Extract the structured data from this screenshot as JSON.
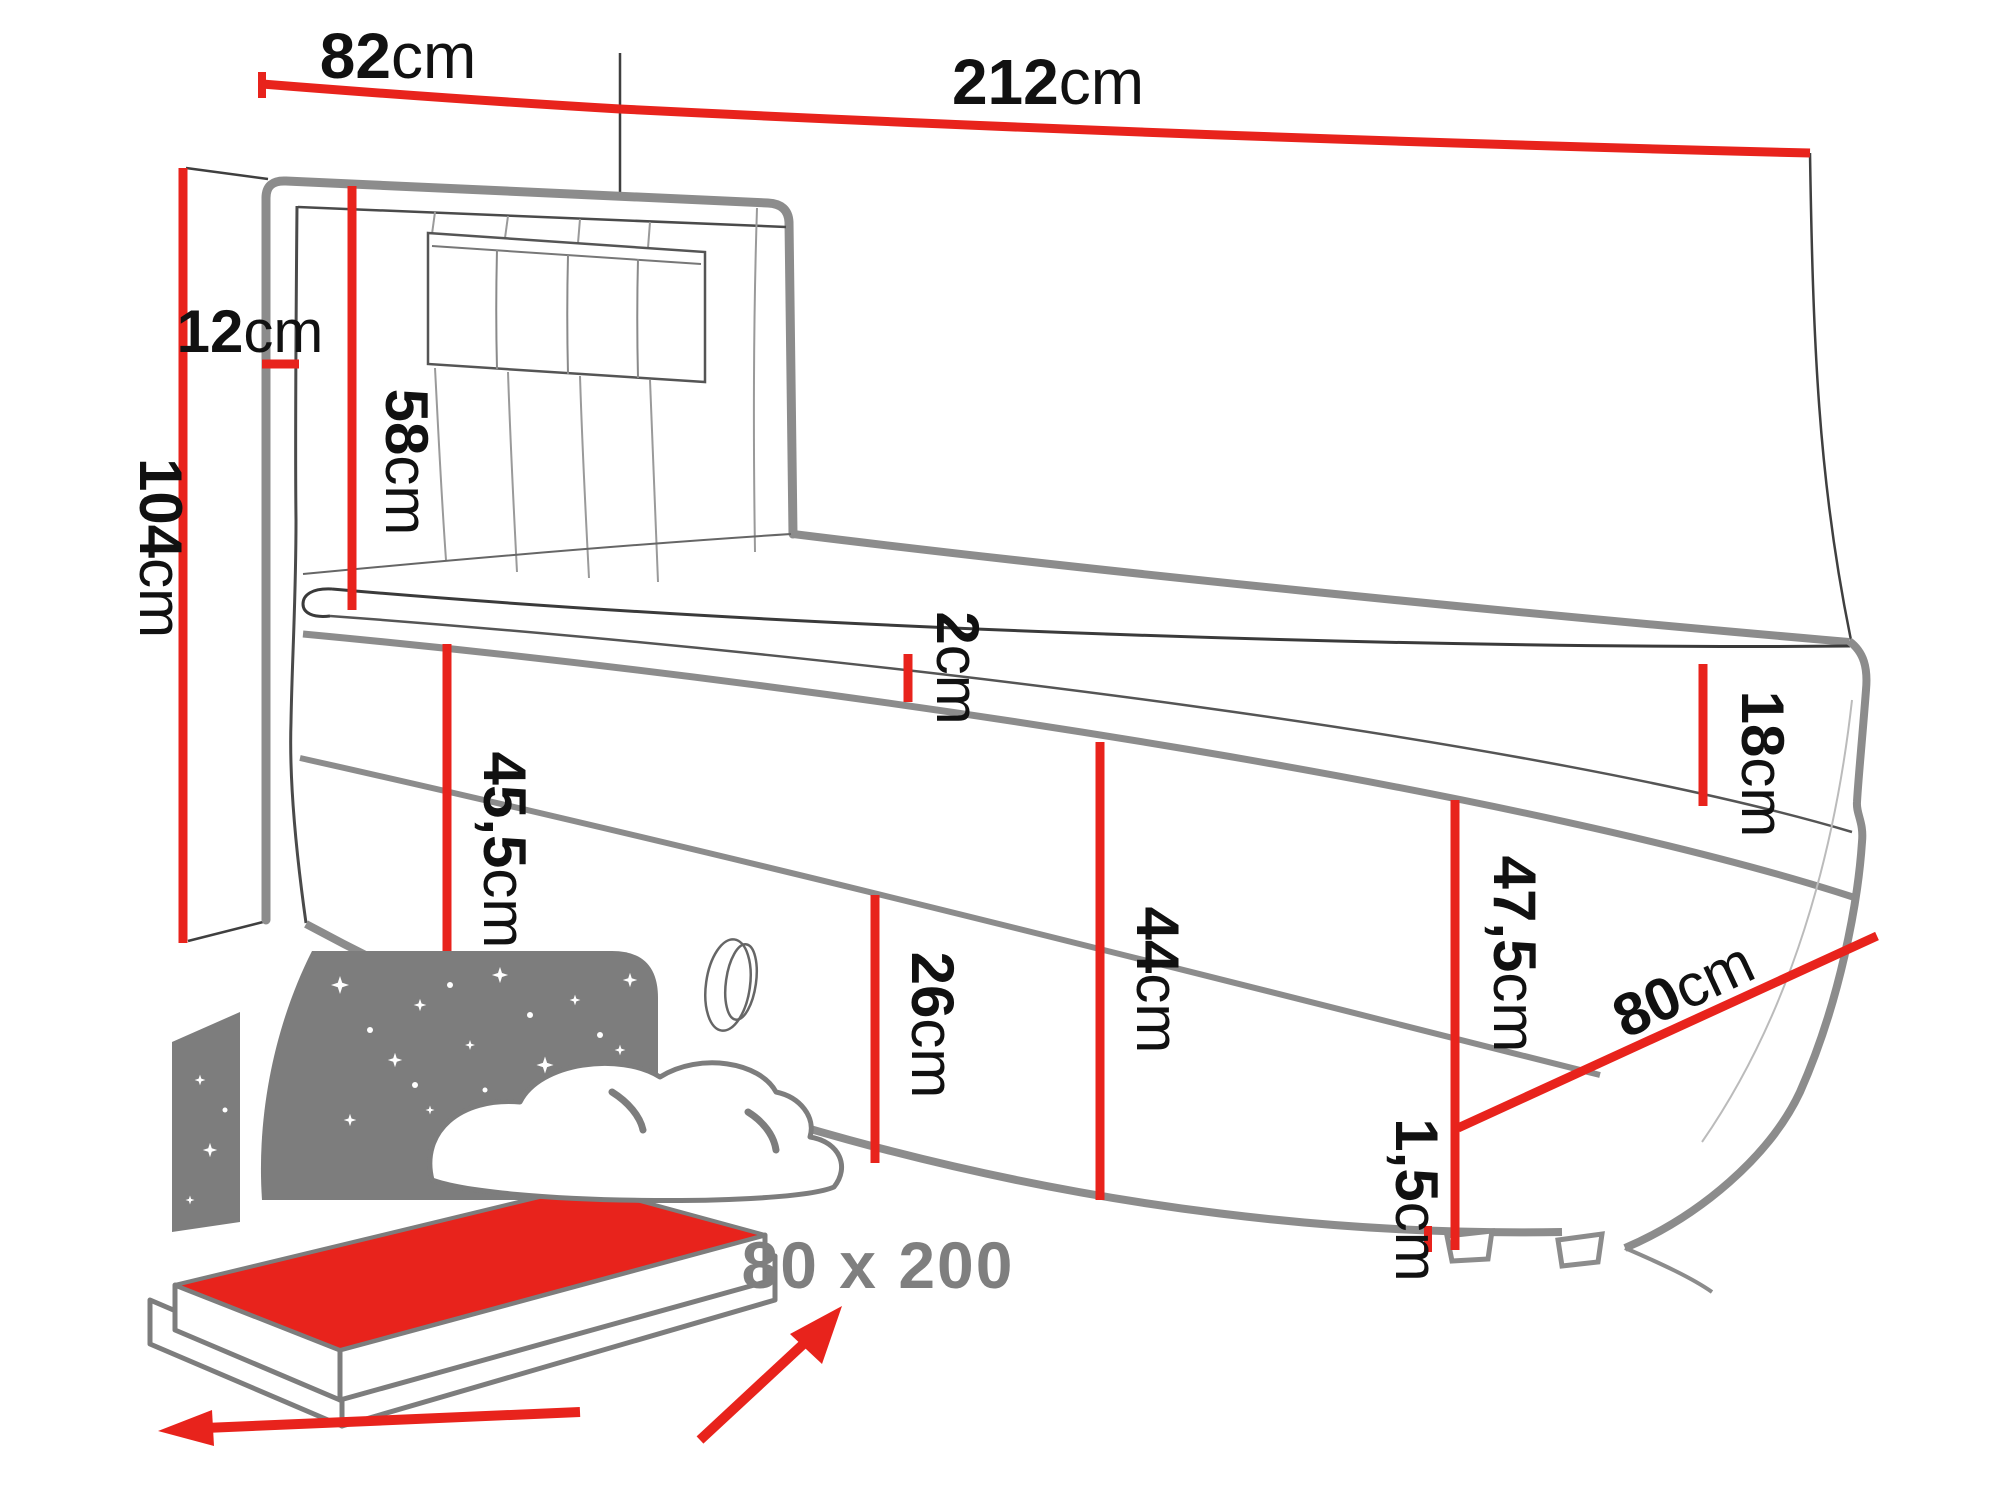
{
  "diagram": {
    "type": "furniture-dimension-drawing",
    "subject": "boxspring single bed with storage, dimension callouts",
    "size_label": "80 x 200",
    "labels": {
      "d82": {
        "num": "82",
        "unit": "cm"
      },
      "d212": {
        "num": "212",
        "unit": "cm"
      },
      "d104": {
        "num": "104",
        "unit": "cm"
      },
      "d12": {
        "num": "12",
        "unit": "cm"
      },
      "d58": {
        "num": "58",
        "unit": "cm"
      },
      "d2": {
        "num": "2",
        "unit": "cm"
      },
      "d455": {
        "num": "45,5",
        "unit": "cm"
      },
      "d26": {
        "num": "26",
        "unit": "cm"
      },
      "d44": {
        "num": "44",
        "unit": "cm"
      },
      "d18": {
        "num": "18",
        "unit": "cm"
      },
      "d475": {
        "num": "47,5",
        "unit": "cm"
      },
      "d80": {
        "num": "80",
        "unit": "cm"
      },
      "d15": {
        "num": "1,5",
        "unit": "cm"
      }
    },
    "colors": {
      "dimension_red": "#e8231c",
      "outline_gray": "#8c8c8c",
      "thin_line": "#3f3f3f",
      "icon_gray": "#7d7d7d",
      "size_text_gray": "#7f7f7f",
      "label_black": "#111111",
      "background": "#ffffff"
    }
  }
}
